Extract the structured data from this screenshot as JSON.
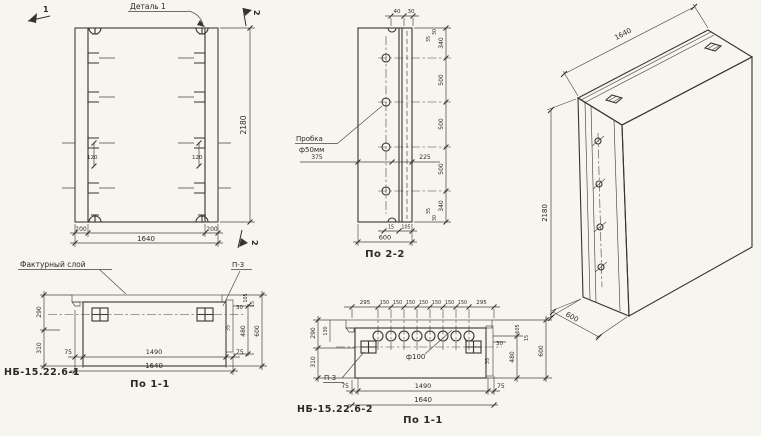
{
  "palette": {
    "paper": "#f6f5f0",
    "ink": "#383429"
  },
  "front": {
    "detail_label": "Деталь 1",
    "cut_mark_1": "1",
    "cut_mark_2_top": "2",
    "cut_mark_2_bottom": "2",
    "dim_anchor_left": "120",
    "dim_anchor_right": "120",
    "dim_col_left": "200",
    "dim_width": "1640",
    "dim_col_right": "200",
    "dim_height": "2180"
  },
  "section22": {
    "title": "По 2-2",
    "plug_label_1": "Пробка",
    "plug_label_2": "ф50мм",
    "dim_top_40": "40",
    "dim_top_30": "30",
    "right_chain": [
      "30",
      "35",
      "340",
      "500",
      "500",
      "500",
      "340",
      "35",
      "30"
    ],
    "dim_mid_left": "375",
    "dim_mid_right": "225",
    "dim_bot_15": "15",
    "dim_bot_105": "105",
    "dim_bot_total": "600",
    "plug_count": 4
  },
  "iso": {
    "dim_width": "1640",
    "dim_height": "2180",
    "dim_depth": "600"
  },
  "section11_1": {
    "code": "НБ-15.22.6-1",
    "title": "По 1-1",
    "layer_label": "Фактурный слой",
    "detail_ref": "П-3",
    "dim_left_top": "290",
    "dim_left_bottom": "310",
    "dim_rib": "30",
    "dim_rib_b": "35",
    "dim_top_105": "105",
    "dim_top_15": "15",
    "dim_480": "480",
    "dim_600": "600",
    "dim_75_left": "75",
    "dim_1490": "1490",
    "dim_75_right": "75",
    "dim_1640": "1640"
  },
  "section11_2": {
    "code": "НБ-15.22.6-2",
    "title": "По 1-1",
    "detail_ref": "П-3",
    "hole_label": "ф100",
    "top_chain": [
      "295",
      "150",
      "150",
      "150",
      "150",
      "150",
      "150",
      "150",
      "295"
    ],
    "dim_left_small": "130",
    "dim_left_top": "290",
    "dim_left_bottom": "310",
    "dim_rib": "30",
    "dim_rib_b": "35",
    "dim_top_105": "105",
    "dim_top_15": "15",
    "dim_480": "480",
    "dim_600": "600",
    "dim_75_left": "75",
    "dim_1490": "1490",
    "dim_75_right": "75",
    "dim_1640": "1640",
    "hole_count": 8
  }
}
